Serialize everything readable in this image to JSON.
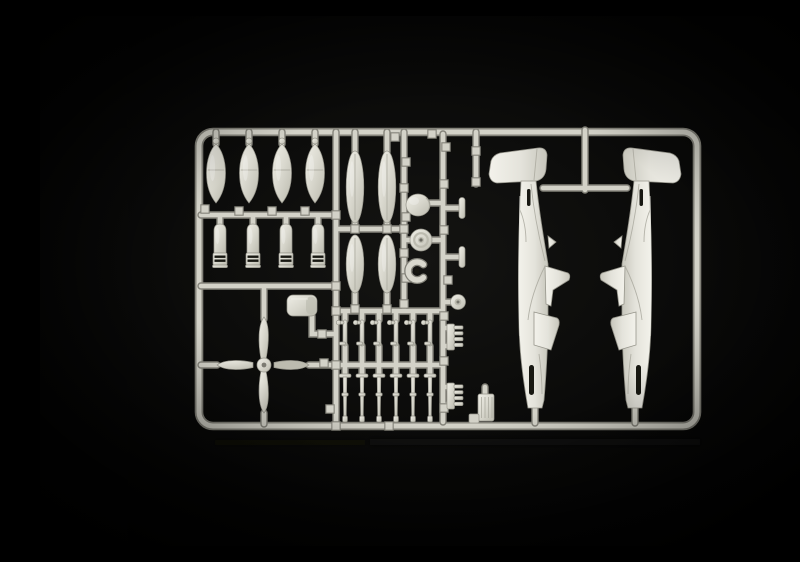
{
  "scene": {
    "alt": "Photograph of a light grey injection-moulded model aircraft sprue on a black background: a rounded rectangular frame holding two fuselage halves, four bombs, four finned bombs, four drop-tank halves, a four-blade propeller, a spinner, a wheel, exhaust stacks, undercarriage legs, doors and small fittings.",
    "plastic_colour": "light grey",
    "background_colour": "black"
  },
  "colors": {
    "bg-center": "#141412",
    "bg-mid": "#0a0a09",
    "bg-edge": "#000000",
    "plastic-hi": "#efeee6",
    "plastic": "#d9d8ce",
    "plastic-lo": "#bcbbaf",
    "plastic-edge": "#96958b",
    "runner": "#d3d2c8",
    "runner-shadow": "#84837a",
    "fuselage-hi": "#f3f2eb",
    "fuselage": "#e4e3db",
    "fuselage-lo": "#c7c6bc",
    "slot": "#181812",
    "detail-line": "#a9a89d",
    "reflection": "#15150d"
  },
  "parts": [
    {
      "name": "fuselage half",
      "count": 2
    },
    {
      "name": "large bomb",
      "count": 4
    },
    {
      "name": "finned bomb",
      "count": 4
    },
    {
      "name": "drop-tank half",
      "count": 4
    },
    {
      "name": "four-blade propeller",
      "count": 1
    },
    {
      "name": "propeller spinner",
      "count": 1
    },
    {
      "name": "main wheel",
      "count": 1
    },
    {
      "name": "tail wheel disc",
      "count": 1
    },
    {
      "name": "cowl ring",
      "count": 1
    },
    {
      "name": "carburettor air scoop",
      "count": 1
    },
    {
      "name": "undercarriage door",
      "count": 6
    },
    {
      "name": "undercarriage leg",
      "count": 6
    },
    {
      "name": "exhaust stack",
      "count": 2
    },
    {
      "name": "radiator core",
      "count": 1
    },
    {
      "name": "mounting bracket",
      "count": 2
    }
  ]
}
